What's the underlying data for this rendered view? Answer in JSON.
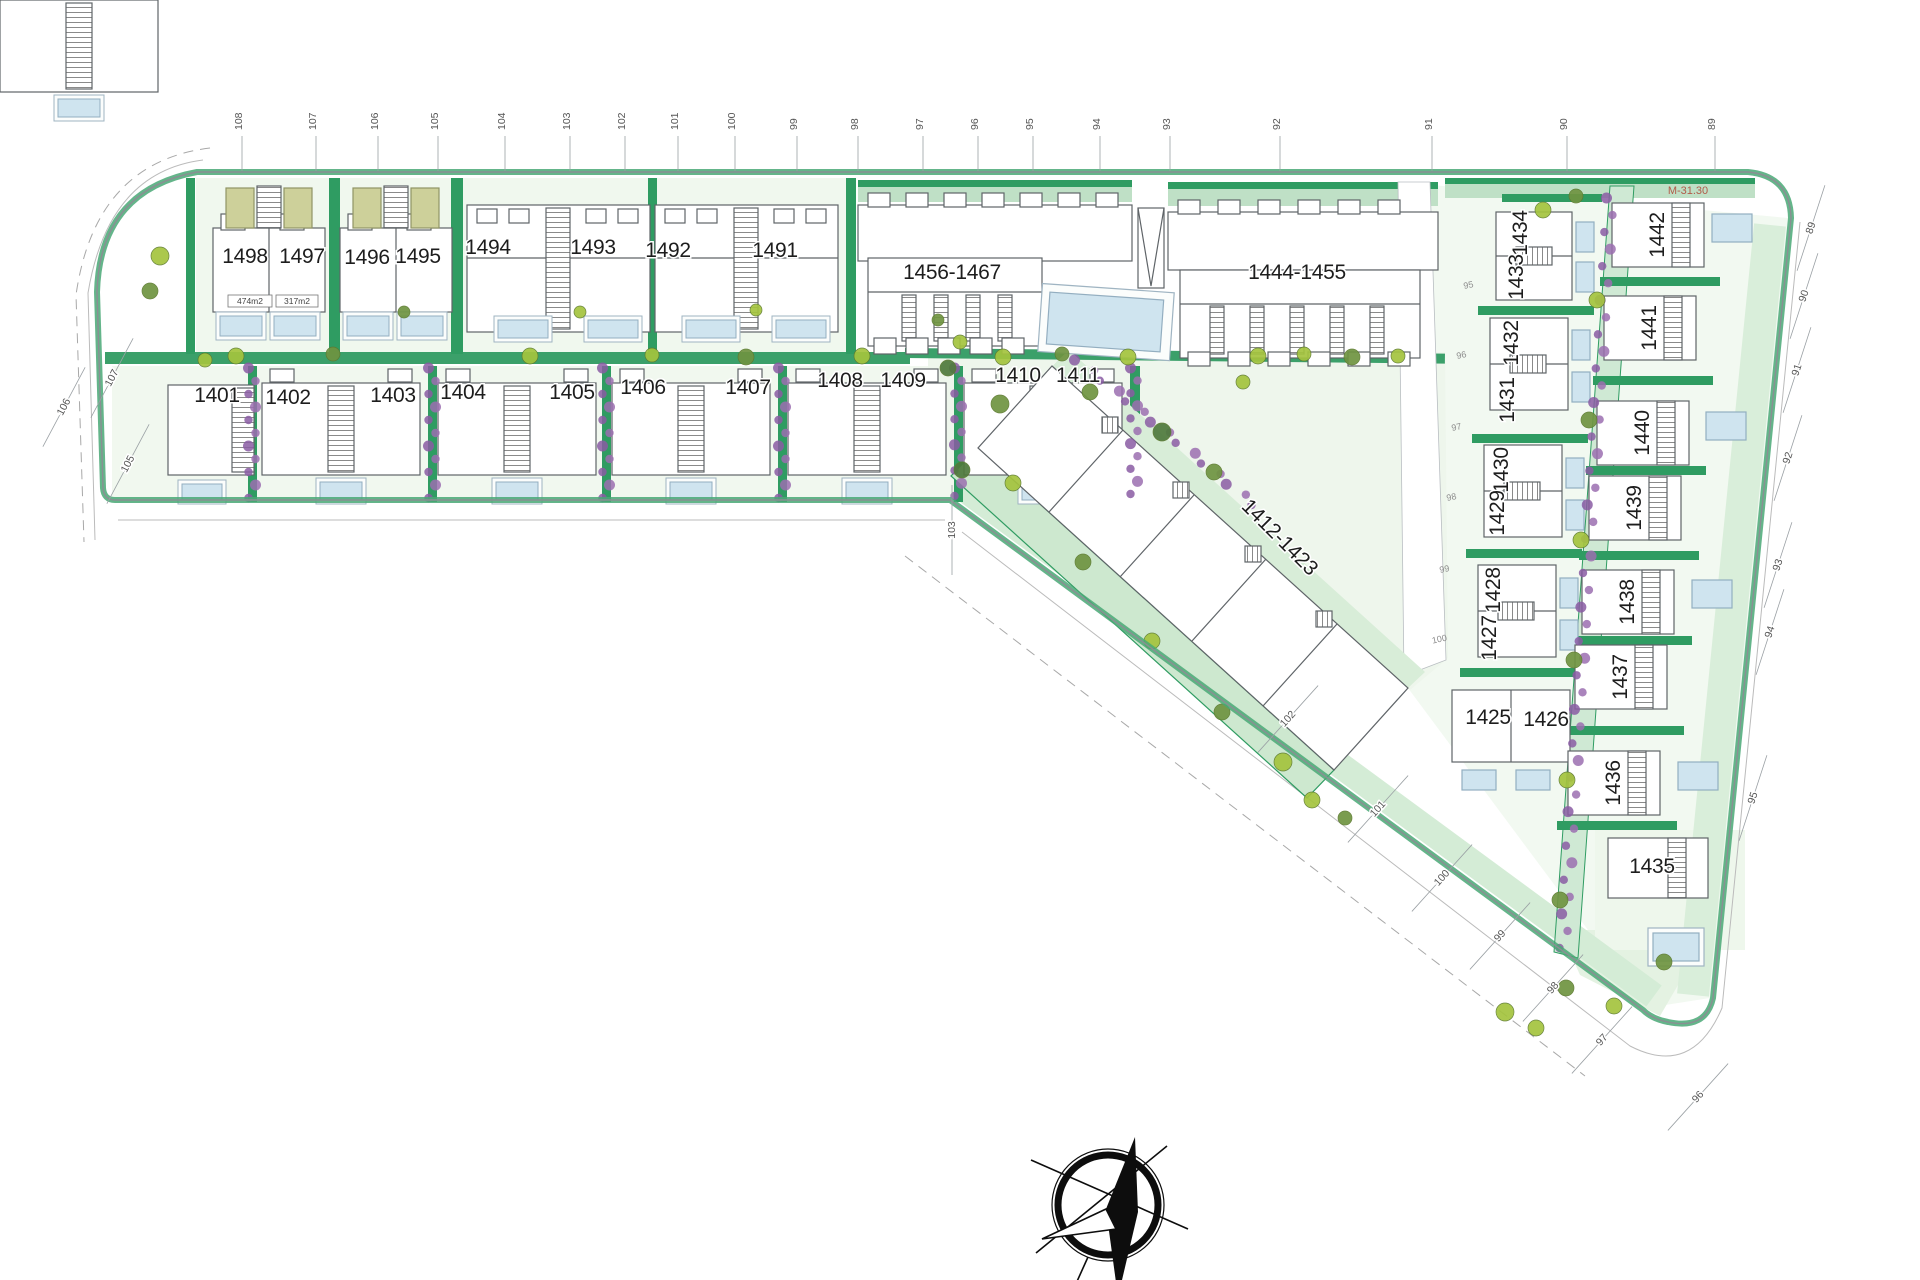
{
  "plan": {
    "red_note": "M-31.30",
    "area_label_1": "474m2",
    "area_label_2": "317m2",
    "colors": {
      "hedge": "#2f9c62",
      "hedge_dark": "#1f7a49",
      "lawn": "#dff0dd",
      "lawn2": "#cde8cf",
      "pale": "#f1f8ef",
      "pool": "#cfe4ef",
      "purple": "#9b6fb0",
      "purple2": "#8a5ca3",
      "lime": "#a4c43e",
      "olive": "#6f9441",
      "dark_olive": "#4f7a3d",
      "outline": "#5f6468",
      "boundary": "#8a8f93",
      "label": "#1d1d1d",
      "tick": "#555555",
      "station": "#8d8d8d",
      "red": "#b15b49",
      "deck": "#cdd09a"
    },
    "plots": [
      {
        "id": "1498",
        "x": 245,
        "y": 256,
        "rot": 0
      },
      {
        "id": "1497",
        "x": 302,
        "y": 256,
        "rot": 0
      },
      {
        "id": "1496",
        "x": 367,
        "y": 257,
        "rot": 0
      },
      {
        "id": "1495",
        "x": 418,
        "y": 256,
        "rot": 0
      },
      {
        "id": "1494",
        "x": 488,
        "y": 247,
        "rot": 0
      },
      {
        "id": "1493",
        "x": 593,
        "y": 247,
        "rot": 0
      },
      {
        "id": "1492",
        "x": 668,
        "y": 250,
        "rot": 0
      },
      {
        "id": "1491",
        "x": 775,
        "y": 250,
        "rot": 0
      },
      {
        "id": "1456-1467",
        "x": 952,
        "y": 272,
        "rot": 0
      },
      {
        "id": "1444-1455",
        "x": 1297,
        "y": 272,
        "rot": 0
      },
      {
        "id": "1401",
        "x": 217,
        "y": 395,
        "rot": 0
      },
      {
        "id": "1402",
        "x": 288,
        "y": 397,
        "rot": 0
      },
      {
        "id": "1403",
        "x": 393,
        "y": 395,
        "rot": 0
      },
      {
        "id": "1404",
        "x": 463,
        "y": 392,
        "rot": 0
      },
      {
        "id": "1405",
        "x": 572,
        "y": 392,
        "rot": 0
      },
      {
        "id": "1406",
        "x": 643,
        "y": 387,
        "rot": 0
      },
      {
        "id": "1407",
        "x": 748,
        "y": 387,
        "rot": 0
      },
      {
        "id": "1408",
        "x": 840,
        "y": 380,
        "rot": 0
      },
      {
        "id": "1409",
        "x": 903,
        "y": 380,
        "rot": 0
      },
      {
        "id": "1410",
        "x": 1018,
        "y": 375,
        "rot": 0
      },
      {
        "id": "1411",
        "x": 1078,
        "y": 375,
        "rot": 0
      },
      {
        "id": "1412-1423",
        "x": 1280,
        "y": 537,
        "rot": 45
      },
      {
        "id": "1434",
        "x": 1520,
        "y": 233,
        "rot": -90
      },
      {
        "id": "1433",
        "x": 1516,
        "y": 277,
        "rot": -90
      },
      {
        "id": "1432",
        "x": 1511,
        "y": 343,
        "rot": -90
      },
      {
        "id": "1431",
        "x": 1507,
        "y": 400,
        "rot": -90
      },
      {
        "id": "1430",
        "x": 1501,
        "y": 470,
        "rot": -90
      },
      {
        "id": "1429",
        "x": 1497,
        "y": 513,
        "rot": -90
      },
      {
        "id": "1428",
        "x": 1493,
        "y": 590,
        "rot": -90
      },
      {
        "id": "1427",
        "x": 1489,
        "y": 638,
        "rot": -90
      },
      {
        "id": "1425",
        "x": 1488,
        "y": 717,
        "rot": 0
      },
      {
        "id": "1426",
        "x": 1546,
        "y": 719,
        "rot": 0
      },
      {
        "id": "1442",
        "x": 1657,
        "y": 235,
        "rot": -90
      },
      {
        "id": "1441",
        "x": 1649,
        "y": 328,
        "rot": -90
      },
      {
        "id": "1440",
        "x": 1642,
        "y": 433,
        "rot": -90
      },
      {
        "id": "1439",
        "x": 1634,
        "y": 508,
        "rot": -90
      },
      {
        "id": "1438",
        "x": 1627,
        "y": 602,
        "rot": -90
      },
      {
        "id": "1437",
        "x": 1620,
        "y": 677,
        "rot": -90
      },
      {
        "id": "1436",
        "x": 1613,
        "y": 783,
        "rot": -90
      },
      {
        "id": "1435",
        "x": 1652,
        "y": 866,
        "rot": 0
      }
    ],
    "top_ticks": [
      {
        "t": "108",
        "x": 242
      },
      {
        "t": "107",
        "x": 316
      },
      {
        "t": "106",
        "x": 378
      },
      {
        "t": "105",
        "x": 438
      },
      {
        "t": "104",
        "x": 505
      },
      {
        "t": "103",
        "x": 570
      },
      {
        "t": "102",
        "x": 625
      },
      {
        "t": "101",
        "x": 678
      },
      {
        "t": "100",
        "x": 735
      },
      {
        "t": "99",
        "x": 797
      },
      {
        "t": "98",
        "x": 858
      },
      {
        "t": "97",
        "x": 923
      },
      {
        "t": "96",
        "x": 978
      },
      {
        "t": "95",
        "x": 1033
      },
      {
        "t": "94",
        "x": 1100
      },
      {
        "t": "93",
        "x": 1170
      },
      {
        "t": "92",
        "x": 1280
      },
      {
        "t": "91",
        "x": 1432
      },
      {
        "t": "90",
        "x": 1567
      },
      {
        "t": "89",
        "x": 1715
      }
    ],
    "side_ticks": [
      {
        "t": "107",
        "x": 112,
        "y": 378,
        "rot": -62
      },
      {
        "t": "106",
        "x": 64,
        "y": 407,
        "rot": -62
      },
      {
        "t": "105",
        "x": 128,
        "y": 464,
        "rot": -62
      },
      {
        "t": "103",
        "x": 952,
        "y": 530,
        "rot": -90
      },
      {
        "t": "102",
        "x": 1288,
        "y": 719,
        "rot": -48
      },
      {
        "t": "101",
        "x": 1378,
        "y": 809,
        "rot": -48
      },
      {
        "t": "100",
        "x": 1442,
        "y": 878,
        "rot": -48
      },
      {
        "t": "99",
        "x": 1500,
        "y": 936,
        "rot": -48
      },
      {
        "t": "98",
        "x": 1553,
        "y": 988,
        "rot": -48
      },
      {
        "t": "97",
        "x": 1602,
        "y": 1040,
        "rot": -48
      },
      {
        "t": "96",
        "x": 1698,
        "y": 1097,
        "rot": -48
      },
      {
        "t": "89",
        "x": 1811,
        "y": 228,
        "rot": -72
      },
      {
        "t": "90",
        "x": 1804,
        "y": 296,
        "rot": -72
      },
      {
        "t": "91",
        "x": 1797,
        "y": 370,
        "rot": -72
      },
      {
        "t": "92",
        "x": 1788,
        "y": 458,
        "rot": -72
      },
      {
        "t": "93",
        "x": 1778,
        "y": 565,
        "rot": -72
      },
      {
        "t": "94",
        "x": 1770,
        "y": 632,
        "rot": -72
      },
      {
        "t": "95",
        "x": 1753,
        "y": 798,
        "rot": -72
      }
    ],
    "road_stations": [
      {
        "t": "95",
        "x": 1469,
        "y": 288
      },
      {
        "t": "96",
        "x": 1462,
        "y": 358
      },
      {
        "t": "97",
        "x": 1457,
        "y": 430
      },
      {
        "t": "98",
        "x": 1452,
        "y": 500
      },
      {
        "t": "99",
        "x": 1445,
        "y": 572
      },
      {
        "t": "100",
        "x": 1440,
        "y": 642
      }
    ],
    "trees": [
      [
        160,
        256,
        9,
        0
      ],
      [
        150,
        291,
        8,
        1
      ],
      [
        205,
        360,
        7,
        0
      ],
      [
        236,
        356,
        8,
        0
      ],
      [
        333,
        354,
        7,
        1
      ],
      [
        530,
        356,
        8,
        0
      ],
      [
        652,
        355,
        7,
        0
      ],
      [
        746,
        357,
        8,
        1
      ],
      [
        862,
        356,
        8,
        0
      ],
      [
        1003,
        357,
        8,
        0
      ],
      [
        1062,
        354,
        7,
        1
      ],
      [
        1128,
        357,
        8,
        0
      ],
      [
        1258,
        356,
        8,
        0
      ],
      [
        1304,
        354,
        7,
        0
      ],
      [
        1352,
        357,
        8,
        1
      ],
      [
        1398,
        356,
        7,
        0
      ],
      [
        948,
        368,
        8,
        2
      ],
      [
        1000,
        404,
        9,
        1
      ],
      [
        962,
        470,
        8,
        2
      ],
      [
        1090,
        392,
        8,
        1
      ],
      [
        1162,
        432,
        9,
        2
      ],
      [
        1214,
        472,
        8,
        1
      ],
      [
        1243,
        382,
        7,
        0
      ],
      [
        1013,
        483,
        8,
        0
      ],
      [
        1083,
        562,
        8,
        1
      ],
      [
        1152,
        641,
        8,
        0
      ],
      [
        1222,
        712,
        8,
        1
      ],
      [
        1283,
        762,
        9,
        0
      ],
      [
        1312,
        800,
        8,
        0
      ],
      [
        1345,
        818,
        7,
        1
      ],
      [
        1597,
        300,
        8,
        0
      ],
      [
        1589,
        420,
        8,
        1
      ],
      [
        1581,
        540,
        8,
        0
      ],
      [
        1574,
        660,
        8,
        1
      ],
      [
        1567,
        780,
        8,
        0
      ],
      [
        1560,
        900,
        8,
        1
      ],
      [
        1543,
        210,
        8,
        0
      ],
      [
        1576,
        196,
        7,
        1
      ],
      [
        1505,
        1012,
        9,
        0
      ],
      [
        1536,
        1028,
        8,
        0
      ],
      [
        1566,
        988,
        8,
        1
      ],
      [
        1614,
        1006,
        8,
        0
      ],
      [
        1664,
        962,
        8,
        1
      ],
      [
        756,
        310,
        6,
        0
      ],
      [
        580,
        312,
        6,
        0
      ],
      [
        404,
        312,
        6,
        1
      ],
      [
        960,
        342,
        7,
        0
      ],
      [
        938,
        320,
        6,
        1
      ]
    ],
    "shrub_bands": [
      [
        252,
        368,
        252,
        498,
        10
      ],
      [
        432,
        368,
        432,
        498,
        10
      ],
      [
        606,
        368,
        606,
        498,
        10
      ],
      [
        782,
        368,
        782,
        498,
        10
      ],
      [
        958,
        368,
        958,
        496,
        10
      ],
      [
        1134,
        368,
        1134,
        494,
        10
      ],
      [
        1078,
        360,
        1255,
        505,
        14
      ],
      [
        1610,
        198,
        1563,
        948,
        44
      ]
    ],
    "compass": {
      "name": "north-arrow"
    }
  }
}
